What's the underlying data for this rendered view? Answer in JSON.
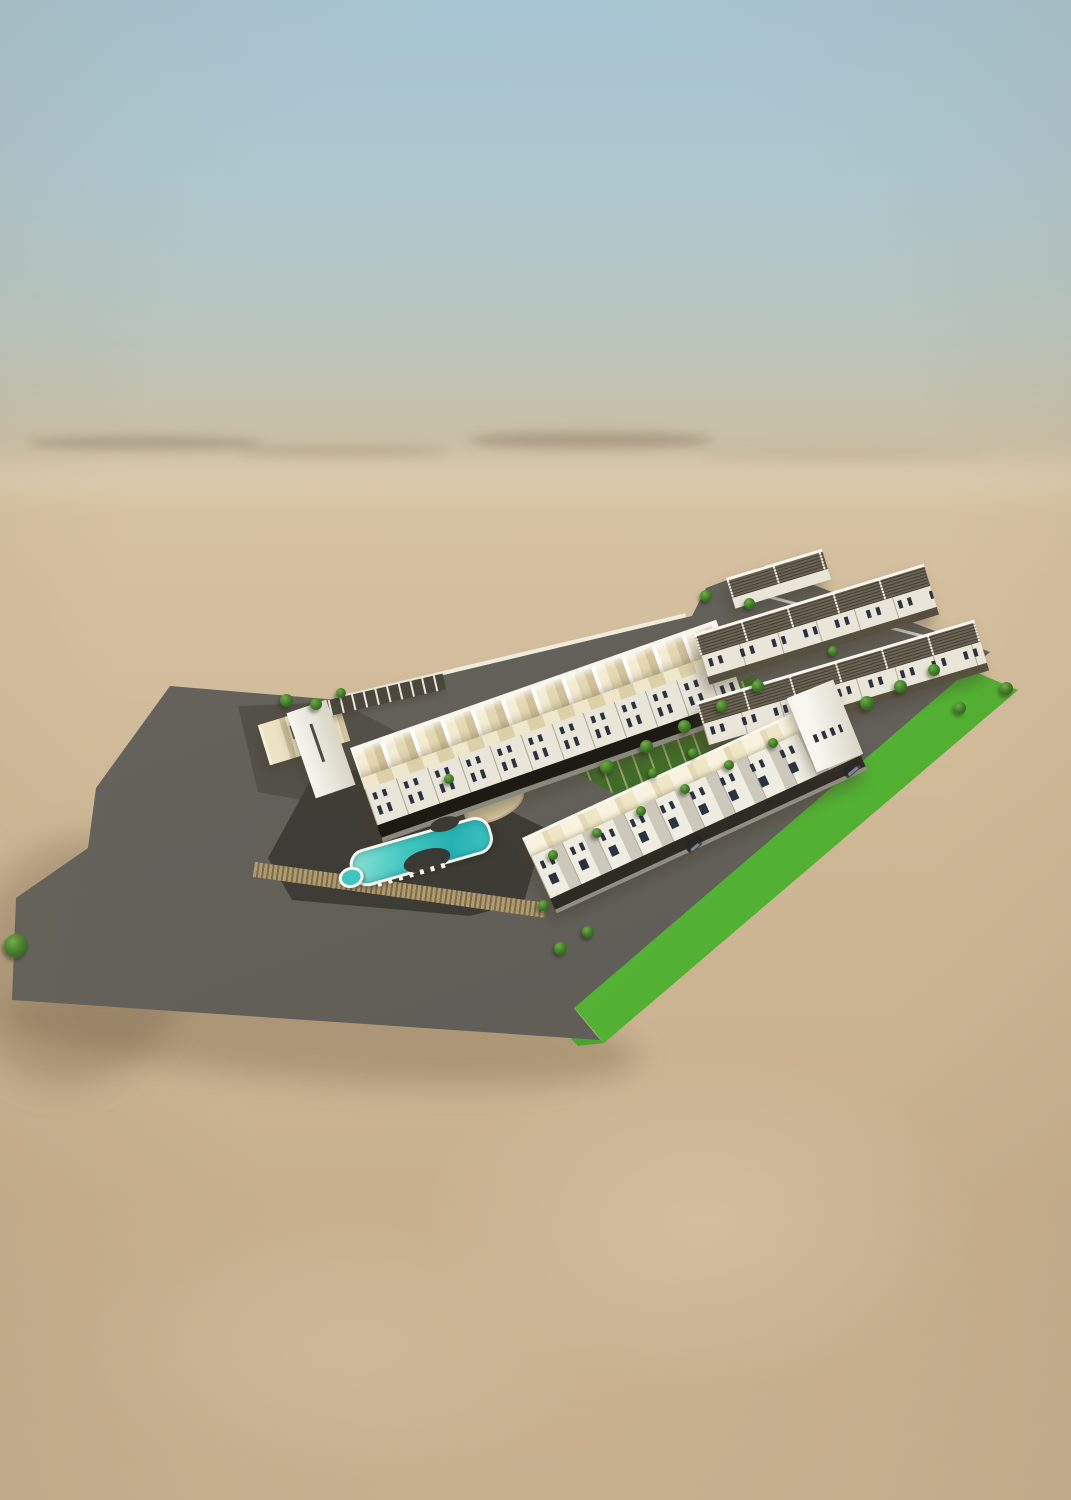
{
  "scene": {
    "kind": "aerial 3d architectural rendering",
    "environment": "empty desert under hazy blue sky",
    "development": {
      "type": "walled residential compound of white townhouse terraces",
      "visible_features": [
        "long gabled townhouse terrace (north)",
        "middle townhouse terrace facing east road",
        "front townhouse terrace with pergola roofs (south)",
        "left wing terrace with alternating cream and slatted roof panels",
        "villa cluster with slatted roof decks (north-east)",
        "curved swimming pool with round spa and sun loungers",
        "central courtyard garden with trees and paths",
        "bright green perimeter lawn strip",
        "grey internal roads",
        "entrance gate structure",
        "two dark parked cars",
        "scattered small trees",
        "tan playground patch"
      ],
      "approx_counts": {
        "terrace_rows": 5,
        "villa_cluster_rows": 3,
        "cars": 2,
        "courtyard_trees": 7
      }
    }
  },
  "palette": {
    "skyTop": "#a7c4d2",
    "skyMid": "#b9c5bd",
    "horizonHaze": "#d5c2a3",
    "sandLight": "#d2bd9c",
    "sand": "#cbb593",
    "sandDeep": "#c8b08e",
    "lawn": "#5fc23a",
    "lawnDark": "#4aa52e",
    "road": "#63615a",
    "roadLight": "#6f6d66",
    "deck": "#45443c",
    "deckDark": "#3a3933",
    "playSand": "#d9c9a2",
    "courtGreen": "#4f7c33",
    "courtDark": "#35611f",
    "roofCream": "#ece2c4",
    "roofPale": "#f6efdb",
    "roofShade": "#d3c59d",
    "facade": "#e9e5d8",
    "facadeB": "#efece1",
    "white": "#f8f6ef",
    "slat": "#6b6353",
    "winGlass": "#2b3240",
    "opening": "#1d1a14",
    "pier": "#d8d4c6",
    "poolAqua": "#3fc6c0",
    "poolLight": "#8fe2d6",
    "poolDeep": "#27b0b2",
    "coping": "#f4f6f0",
    "treeHi": "#6fae45",
    "tree": "#3e7527",
    "treeDark": "#2a551b",
    "pergola": "#b09a6e",
    "pergolaDark": "#7c6c4e",
    "carBody": "#26282c",
    "shadow": "rgba(72,60,42,0.38)"
  }
}
